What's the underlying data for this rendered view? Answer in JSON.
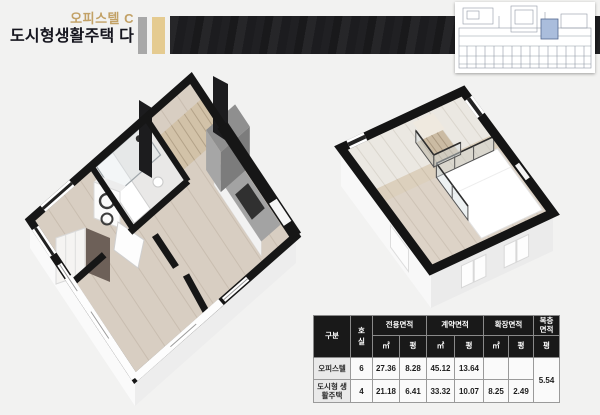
{
  "header": {
    "unit_label": "오피스텔 C",
    "title": "도시형생활주택 다"
  },
  "colors": {
    "accent_gold": "#c2a166",
    "accent_tan_bar": "#e5cb90",
    "accent_gray_bar": "#a8a8a8",
    "banner_black": "#1c1c1f",
    "table_header_bg": "#191919",
    "keyplan_highlight": "#aabddc"
  },
  "figures": {
    "lower_plan": "floor-plan-3d-lower-level",
    "upper_plan": "floor-plan-3d-upper-loft",
    "key_plan": "building-key-plan-blueprint"
  },
  "table": {
    "col_category": "구분",
    "col_room": "호실",
    "col_exclusive": "전용면적",
    "col_contract": "계약면적",
    "col_extended": "확장면적",
    "col_duplex": "복층면적",
    "unit_sqm": "㎡",
    "unit_pyeong": "평",
    "rows": [
      {
        "category": "오피스텔",
        "room": "6",
        "exclusive_sqm": "27.36",
        "exclusive_py": "8.28",
        "contract_sqm": "45.12",
        "contract_py": "13.64",
        "extended_sqm": "",
        "extended_py": ""
      },
      {
        "category": "도시형 생활주택",
        "room": "4",
        "exclusive_sqm": "21.18",
        "exclusive_py": "6.41",
        "contract_sqm": "33.32",
        "contract_py": "10.07",
        "extended_sqm": "8.25",
        "extended_py": "2.49"
      }
    ],
    "duplex_value": "5.54"
  }
}
